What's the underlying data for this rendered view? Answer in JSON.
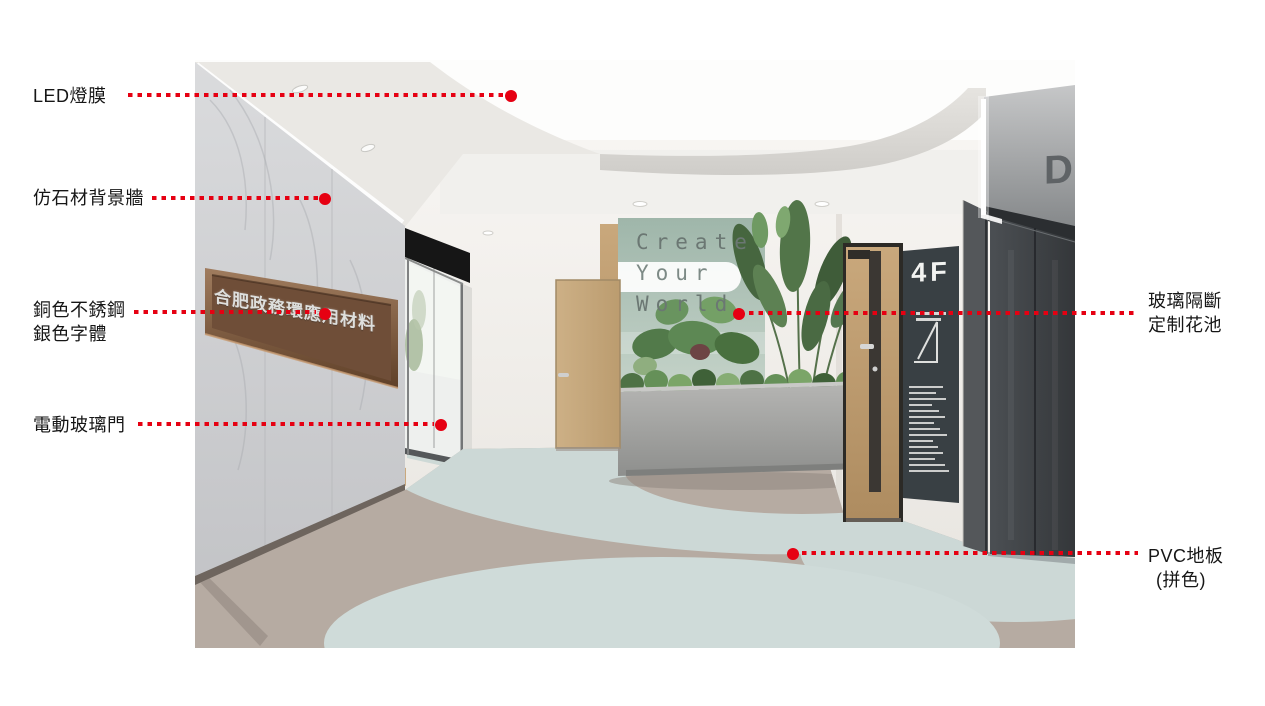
{
  "annotations": {
    "led": "LED燈膜",
    "stone": "仿石材背景牆",
    "copper_line1": "銅色不銹鋼",
    "copper_line2": "銀色字體",
    "glass_door": "電動玻璃門",
    "partition_line1": "玻璃隔斷",
    "partition_line2": "定制花池",
    "pvc_line1": "PVC地板",
    "pvc_line2": "(拼色)"
  },
  "scene": {
    "wall_sign_text": "合肥政務環應用材料",
    "slogan_line1": "Create",
    "slogan_line2": "Your",
    "slogan_line3": "World",
    "floor_sign": "4F",
    "elevator_panel_letter": "D"
  },
  "colors": {
    "annotation_red": "#e60012",
    "floor_base": "#b6aba2",
    "floor_accent": "#ccd8d6",
    "slogan_wall_green": "#a9beb3",
    "copper_sign": "#7d5b44",
    "elevator_grey": "#45494d",
    "wood_door": "#c3a078"
  }
}
